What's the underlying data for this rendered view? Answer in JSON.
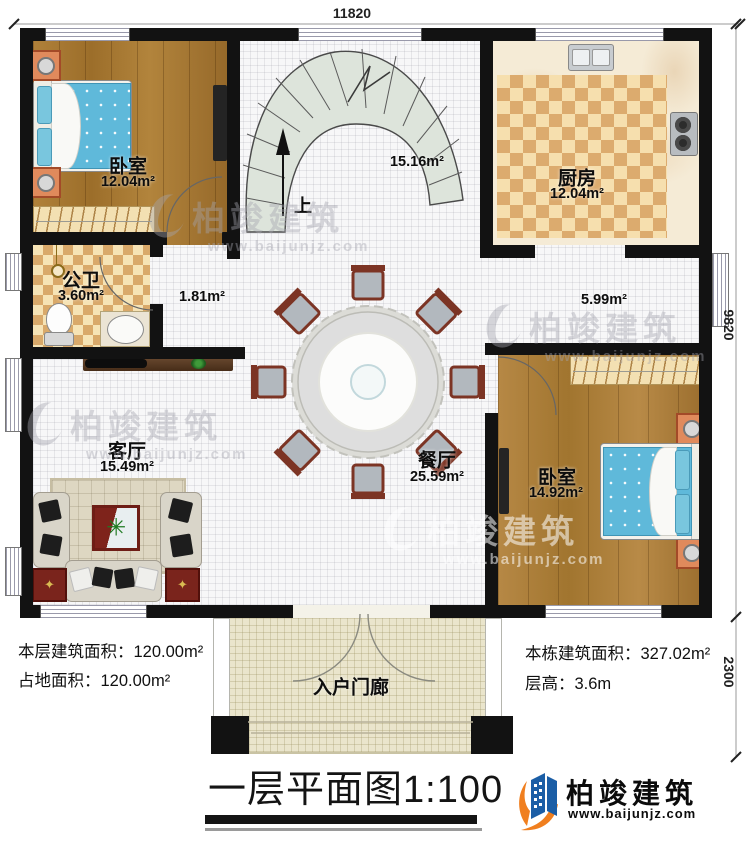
{
  "title": {
    "text": "一层平面图",
    "scale": "1:100"
  },
  "dimensions": {
    "top_width": "11820",
    "right_height": "9820",
    "porch_height": "2300"
  },
  "rooms": [
    {
      "name": "卧室",
      "area": "12.04m²"
    },
    {
      "name": "厨房",
      "area": "12.04m²"
    },
    {
      "name": "公卫",
      "area": "3.60m²"
    },
    {
      "name": "客厅",
      "area": "15.49m²"
    },
    {
      "name": "餐厅",
      "area": "25.59m²"
    },
    {
      "name": "卧室",
      "area": "14.92m²"
    },
    {
      "name": "入户门廊"
    }
  ],
  "open_areas": {
    "stair_hall": "15.16m²",
    "hall": "1.81m²",
    "corridor": "5.99m²"
  },
  "stairs": {
    "up_label": "上"
  },
  "stats": {
    "floor_area_label": "本层建筑面积：",
    "floor_area_value": "120.00m²",
    "footprint_label": "占地面积：",
    "footprint_value": "120.00m²",
    "building_area_label": "本栋建筑面积：",
    "building_area_value": "327.02m²",
    "height_label": "层高：",
    "height_value": "3.6m"
  },
  "brand": {
    "name": "柏竣建筑",
    "url": "www.baijunjz.com"
  },
  "watermark": {
    "name": "柏竣建筑",
    "url": "www.baijunjz.com"
  },
  "colors": {
    "wall": "#121212",
    "accent_blue": "#1b5ea6",
    "accent_orange": "#f07f1f"
  }
}
